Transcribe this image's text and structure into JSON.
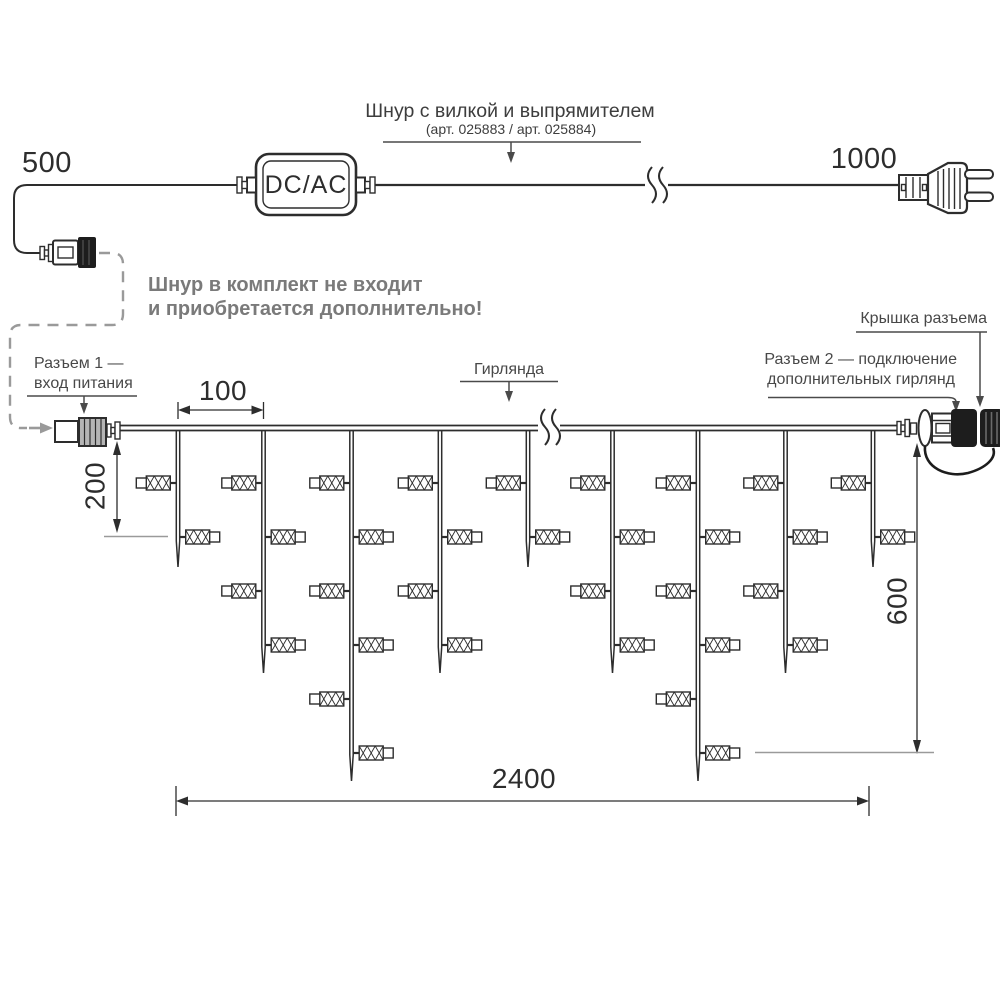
{
  "labels": {
    "cord_title": "Шнур с вилкой и выпрямителем",
    "cord_subtitle": "(арт. 025883 / арт. 025884)",
    "converter": "DC/AC",
    "note_line1": "Шнур в комплект не входит",
    "note_line2": "и приобретается дополнительно!",
    "connector1_line1": "Разъем 1 —",
    "connector1_line2": "вход питания",
    "garland": "Гирлянда",
    "connector_cap": "Крышка разъема",
    "connector2_line1": "Разъем 2 — подключение",
    "connector2_line2": "дополнительных гирлянд"
  },
  "dimensions": {
    "cord_left": "500",
    "cord_right": "1000",
    "drop_spacing": "100",
    "drop_short": "200",
    "drop_long": "600",
    "garland_length": "2400"
  },
  "garland_schematic": {
    "drop_sequence": [
      "short",
      "medium",
      "long",
      "medium",
      "short",
      "medium",
      "long",
      "medium",
      "short"
    ],
    "bulbs_per_drop": {
      "short": 2,
      "medium": 4,
      "long": 6
    }
  },
  "colors": {
    "line": "#2d2d2d",
    "muted": "#9a9a9a",
    "label": "#4a4a4a",
    "note": "#7a7a7a",
    "dark_fill": "#1d1d1d",
    "connector_gray": "#b5b5b5"
  }
}
